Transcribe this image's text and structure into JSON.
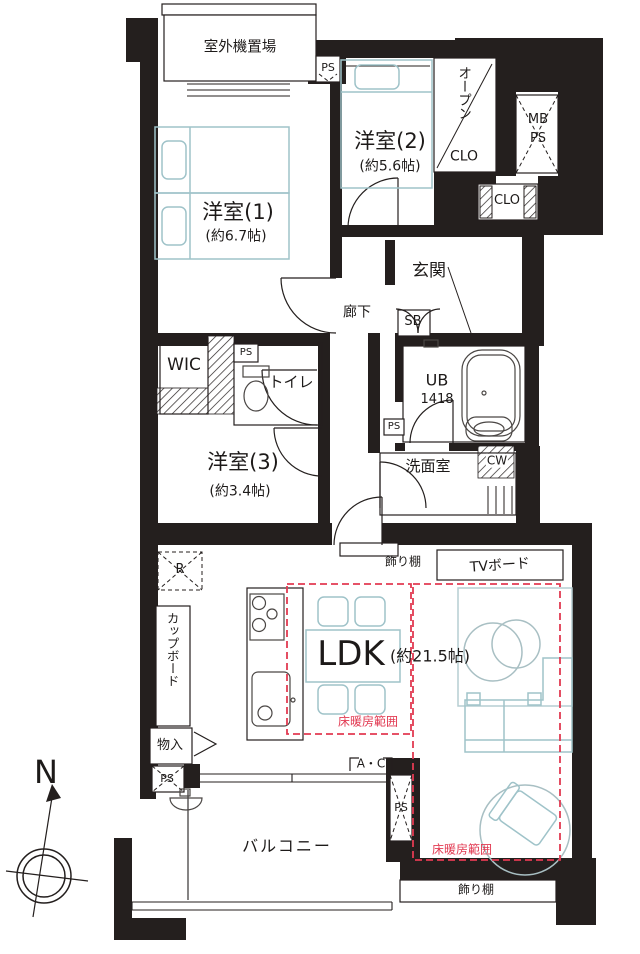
{
  "plan": {
    "compass": "N",
    "outdoor_unit": "室外機置場",
    "labels": {
      "ps": "PS",
      "mb": "MB",
      "sb": "SB",
      "cw": "CW",
      "r": "R",
      "clo": "CLO",
      "open_vertical": "オープン",
      "wic": "WIC",
      "toilet": "トイレ",
      "entrance": "玄関",
      "hallway": "廊下",
      "washroom": "洗面室",
      "cupboard": "カップボード",
      "storage": "物入",
      "shelf": "飾り棚",
      "tv_board": "TVボード",
      "ac": "A・C",
      "balcony": "バルコニー",
      "floor_heating": "床暖房範囲"
    },
    "rooms": {
      "bedroom1": {
        "name": "洋室(1)",
        "size": "(約6.7帖)"
      },
      "bedroom2": {
        "name": "洋室(2)",
        "size": "(約5.6帖)"
      },
      "bedroom3": {
        "name": "洋室(3)",
        "size": "(約3.4帖)"
      },
      "ldk": {
        "name": "LDK",
        "size": "(約21.5帖)"
      },
      "bathroom": {
        "name": "UB",
        "size": "1418"
      }
    },
    "colors": {
      "wall": "#241f1e",
      "furniture": "#9fc3c9",
      "heating": "#e23a52"
    }
  }
}
